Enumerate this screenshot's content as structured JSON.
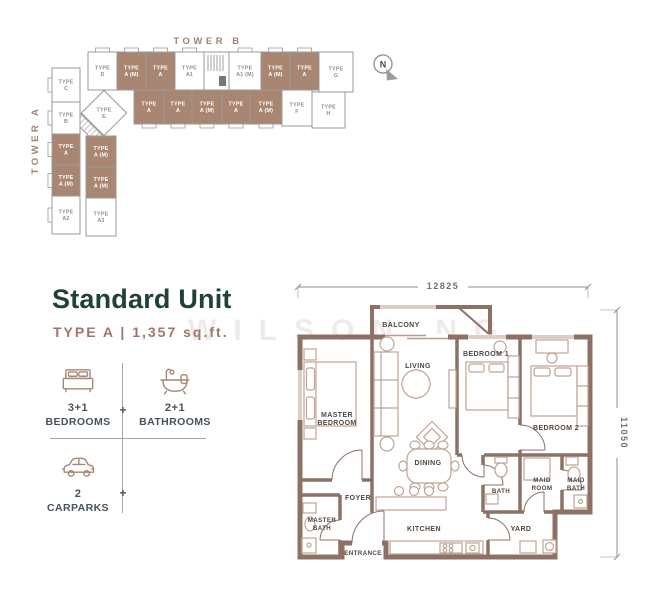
{
  "watermark": "WILSON NG",
  "key_plan": {
    "tower_a_label": "TOWER A",
    "tower_b_label": "TOWER B",
    "compass_label": "N",
    "highlight_color": "#a98672",
    "units": [
      {
        "x": 88,
        "y": 52,
        "w": 29,
        "h": 38,
        "label": "TYPE D",
        "hl": false,
        "tab": "top"
      },
      {
        "x": 117,
        "y": 52,
        "w": 29,
        "h": 38,
        "label": "TYPE A (M)",
        "hl": true,
        "tab": "top"
      },
      {
        "x": 146,
        "y": 52,
        "w": 29,
        "h": 38,
        "label": "TYPE A",
        "hl": true,
        "tab": "top"
      },
      {
        "x": 175,
        "y": 52,
        "w": 29,
        "h": 38,
        "label": "TYPE A1",
        "hl": false,
        "tab": "top"
      },
      {
        "x": 204,
        "y": 52,
        "w": 25,
        "h": 38,
        "label": "",
        "hl": false,
        "core": true
      },
      {
        "x": 229,
        "y": 52,
        "w": 32,
        "h": 38,
        "label": "TYPE A1 (M)",
        "hl": false,
        "tab": "top"
      },
      {
        "x": 261,
        "y": 52,
        "w": 29,
        "h": 38,
        "label": "TYPE A (M)",
        "hl": true,
        "tab": "top"
      },
      {
        "x": 290,
        "y": 52,
        "w": 29,
        "h": 38,
        "label": "TYPE A",
        "hl": true,
        "tab": "top"
      },
      {
        "x": 319,
        "y": 52,
        "w": 34,
        "h": 40,
        "label": "TYPE G",
        "hl": false
      },
      {
        "x": 134,
        "y": 90,
        "w": 30,
        "h": 34,
        "label": "TYPE A",
        "hl": true,
        "tab": "bottom"
      },
      {
        "x": 164,
        "y": 90,
        "w": 28,
        "h": 34,
        "label": "TYPE A",
        "hl": true,
        "tab": "bottom"
      },
      {
        "x": 192,
        "y": 90,
        "w": 30,
        "h": 34,
        "label": "TYPE A (M)",
        "hl": true,
        "tab": "bottom"
      },
      {
        "x": 222,
        "y": 90,
        "w": 28,
        "h": 34,
        "label": "TYPE A",
        "hl": true,
        "tab": "bottom"
      },
      {
        "x": 250,
        "y": 90,
        "w": 32,
        "h": 34,
        "label": "TYPE A (M)",
        "hl": true,
        "tab": "bottom"
      },
      {
        "x": 282,
        "y": 90,
        "w": 30,
        "h": 36,
        "label": "TYPE F",
        "hl": false
      },
      {
        "x": 312,
        "y": 92,
        "w": 33,
        "h": 36,
        "label": "TYPE H",
        "hl": false
      },
      {
        "x": 52,
        "y": 68,
        "w": 28,
        "h": 34,
        "label": "TYPE C",
        "hl": false,
        "tab": "left"
      },
      {
        "x": 52,
        "y": 102,
        "w": 28,
        "h": 32,
        "label": "TYPE B",
        "hl": false,
        "tab": "left"
      },
      {
        "x": 52,
        "y": 134,
        "w": 28,
        "h": 31,
        "label": "TYPE A",
        "hl": true,
        "tab": "left"
      },
      {
        "x": 52,
        "y": 165,
        "w": 28,
        "h": 31,
        "label": "TYPE A (M)",
        "hl": true,
        "tab": "left"
      },
      {
        "x": 52,
        "y": 196,
        "w": 28,
        "h": 38,
        "label": "TYPE A2",
        "hl": false,
        "tab": "left"
      },
      {
        "x": 86,
        "y": 136,
        "w": 30,
        "h": 31,
        "label": "TYPE A (M)",
        "hl": true
      },
      {
        "x": 86,
        "y": 167,
        "w": 30,
        "h": 31,
        "label": "TYPE A (M)",
        "hl": true
      },
      {
        "x": 86,
        "y": 198,
        "w": 30,
        "h": 38,
        "label": "TYPE A3",
        "hl": false
      },
      {
        "x": 88,
        "y": 97,
        "w": 32,
        "h": 32,
        "label": "TYPE E",
        "hl": false,
        "diamond": true
      }
    ]
  },
  "unit_info": {
    "title": "Standard Unit",
    "subtitle": "TYPE A | 1,357 sq.ft.",
    "specs": [
      {
        "icon": "bed-icon",
        "value": "3+1",
        "label": "BEDROOMS"
      },
      {
        "icon": "bath-icon",
        "value": "2+1",
        "label": "BATHROOMS"
      },
      {
        "icon": "car-icon",
        "value": "2",
        "label": "CARPARKS"
      }
    ]
  },
  "floor_plan": {
    "dim_top": "12825",
    "dim_right": "11050",
    "labels": [
      {
        "x": 401,
        "y": 327,
        "lines": [
          "BALCONY"
        ],
        "small": false
      },
      {
        "x": 418,
        "y": 368,
        "lines": [
          "LIVING"
        ],
        "small": false
      },
      {
        "x": 337,
        "y": 417,
        "lines": [
          "MASTER",
          "BEDROOM"
        ],
        "small": false
      },
      {
        "x": 486,
        "y": 356,
        "lines": [
          "BEDROOM 1"
        ],
        "small": false
      },
      {
        "x": 556,
        "y": 430,
        "lines": [
          "BEDROOM 2"
        ],
        "small": false
      },
      {
        "x": 428,
        "y": 465,
        "lines": [
          "DINING"
        ],
        "small": false
      },
      {
        "x": 358,
        "y": 500,
        "lines": [
          "FOYER"
        ],
        "small": false
      },
      {
        "x": 322,
        "y": 522,
        "lines": [
          "MASTER",
          "BATH"
        ],
        "small": true
      },
      {
        "x": 363,
        "y": 555,
        "lines": [
          "ENTRANCE"
        ],
        "small": true
      },
      {
        "x": 424,
        "y": 531,
        "lines": [
          "KITCHEN"
        ],
        "small": false
      },
      {
        "x": 501,
        "y": 493,
        "lines": [
          "BATH"
        ],
        "small": true
      },
      {
        "x": 542,
        "y": 482,
        "lines": [
          "MAID",
          "ROOM"
        ],
        "small": true
      },
      {
        "x": 576,
        "y": 482,
        "lines": [
          "MAID",
          "BATH"
        ],
        "small": true
      },
      {
        "x": 521,
        "y": 531,
        "lines": [
          "YARD"
        ],
        "small": false
      }
    ]
  }
}
